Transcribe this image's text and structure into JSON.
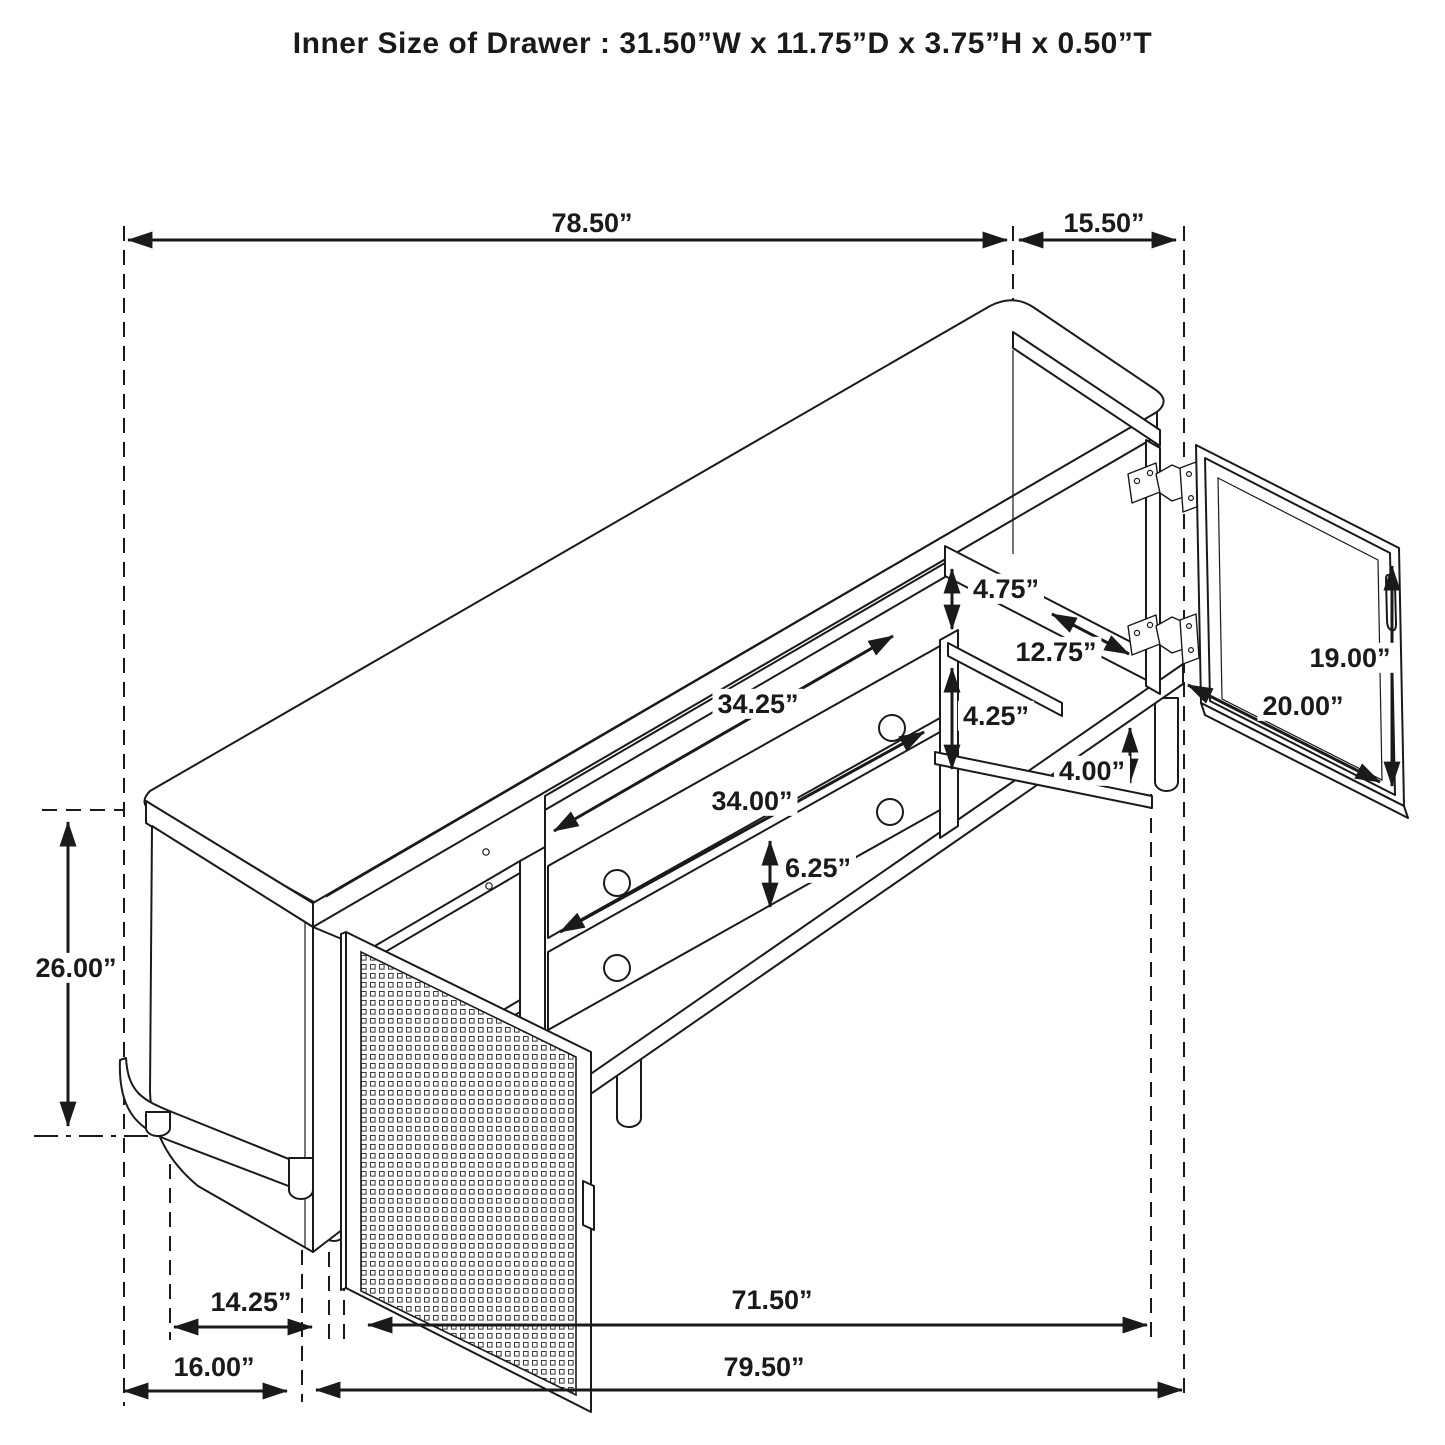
{
  "title": "Inner Size of Drawer : 31.50”W x 11.75”D x 3.75”H x 0.50”T",
  "dims": {
    "d7850": "78.50”",
    "d1550": "15.50”",
    "d475": "4.75”",
    "d1275": "12.75”",
    "d1900": "19.00”",
    "d2000": "20.00”",
    "d3425": "34.25”",
    "d425": "4.25”",
    "d3400": "34.00”",
    "d400": "4.00”",
    "d625": "6.25”",
    "d2600": "26.00”",
    "d1425": "14.25”",
    "d7150": "71.50”",
    "d1600": "16.00”",
    "d7950": "79.50”"
  }
}
